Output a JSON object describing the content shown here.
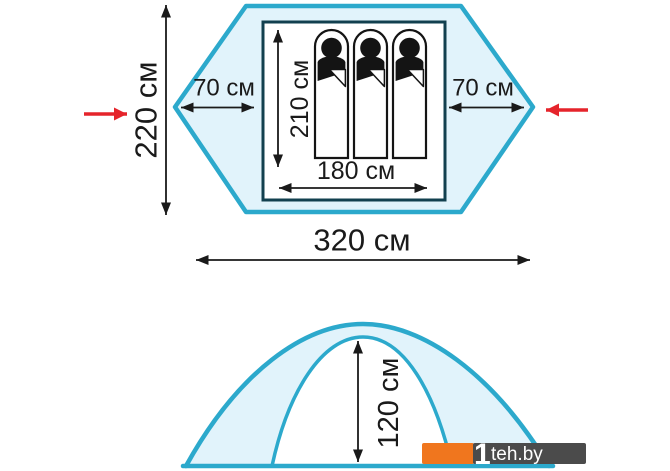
{
  "diagram": {
    "top_view": {
      "depth": {
        "value": 220,
        "unit": "см",
        "label": "220 см"
      },
      "vestibule_left": {
        "value": 70,
        "unit": "см",
        "label": "70 см"
      },
      "vestibule_right": {
        "value": 70,
        "unit": "см",
        "label": "70 см"
      },
      "inner_length": {
        "value": 210,
        "unit": "см",
        "label": "210 см"
      },
      "inner_width": {
        "value": 180,
        "unit": "см",
        "label": "180 см"
      },
      "total_width": {
        "value": 320,
        "unit": "см",
        "label": "320 см"
      },
      "sleeping_places": 3
    },
    "side_view": {
      "inner_height": {
        "value": 120,
        "unit": "см",
        "label": "120 см"
      }
    },
    "watermark": {
      "logo_mark": "1",
      "text": "teh.by",
      "full": "1teh.by"
    },
    "colors": {
      "tent_fill": "#e1f3fb",
      "tent_outline": "#2ca9cc",
      "inner_room_outline": "#12404f",
      "dimension_ink": "#1a1a1a",
      "entrance_arrow_red": "#e5242b",
      "watermark_orange": "#f0761e",
      "watermark_gray": "#4b4b4b"
    },
    "icons": {
      "entrance_left": "red-arrow-right-icon",
      "entrance_right": "red-arrow-left-icon",
      "sleeper": "person-in-sleeping-bag-icon"
    }
  }
}
